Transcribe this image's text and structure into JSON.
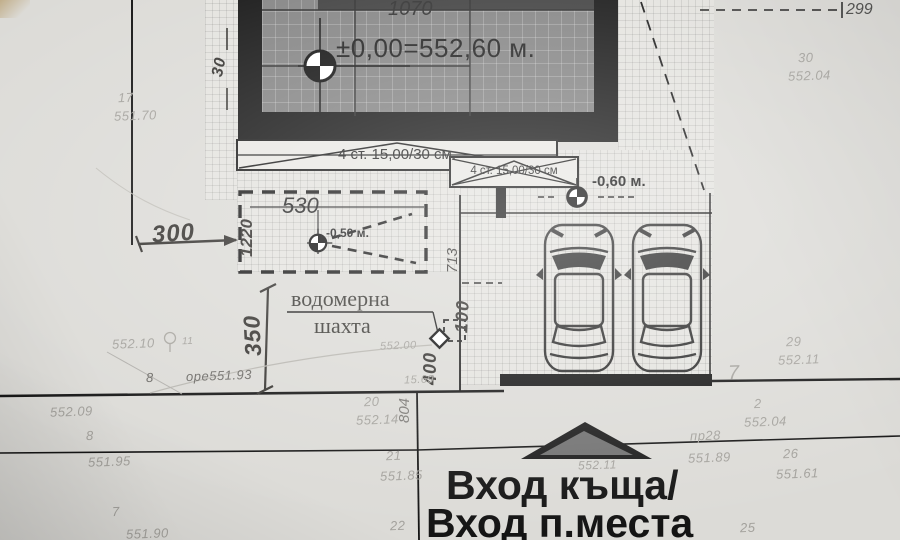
{
  "labels": {
    "dim_1070": "1070",
    "dim_299": "299",
    "elevation_zero": "±0,00=552,60 м.",
    "stairs_1": "4 ст. 15,00/30 см.",
    "stairs_2": "4 ст. 15,00/30 см",
    "dim_530": "530",
    "dim_1220": "1220",
    "terrace_elev": "-0,50 м.",
    "parking_elev": "-0,60 м.",
    "hw_300": "300",
    "hw_350": "350",
    "hw_30": "30",
    "hw_100": "100",
    "hw_400": "400",
    "dim_713": "713",
    "dim_804": "804",
    "water_line1": "водомерна",
    "water_line2": "шахта",
    "entrance_line1": "Вход къща/",
    "entrance_line2": "Вход п.места"
  },
  "survey_points": [
    {
      "label": "17",
      "x": 118,
      "y": 90
    },
    {
      "label": "551.70",
      "x": 114,
      "y": 108
    },
    {
      "label": "30",
      "x": 798,
      "y": 50
    },
    {
      "label": "552.04",
      "x": 788,
      "y": 68
    },
    {
      "label": "29",
      "x": 786,
      "y": 334
    },
    {
      "label": "552.11",
      "x": 778,
      "y": 352
    },
    {
      "label": "552.10",
      "x": 112,
      "y": 336
    },
    {
      "label": "11",
      "x": 182,
      "y": 336,
      "size": 10
    },
    {
      "label": "8",
      "x": 146,
      "y": 370,
      "cls": "dark"
    },
    {
      "label": "оре551.93",
      "x": 186,
      "y": 368,
      "cls": "dark"
    },
    {
      "label": "552.09",
      "x": 50,
      "y": 404
    },
    {
      "label": "8",
      "x": 86,
      "y": 428
    },
    {
      "label": "551.95",
      "x": 88,
      "y": 454
    },
    {
      "label": "7",
      "x": 112,
      "y": 504
    },
    {
      "label": "551.90",
      "x": 126,
      "y": 526
    },
    {
      "label": "20",
      "x": 364,
      "y": 394
    },
    {
      "label": "552.14",
      "x": 356,
      "y": 412
    },
    {
      "label": "21",
      "x": 386,
      "y": 448
    },
    {
      "label": "551.85",
      "x": 380,
      "y": 468
    },
    {
      "label": "22",
      "x": 390,
      "y": 518
    },
    {
      "label": "2",
      "x": 754,
      "y": 396
    },
    {
      "label": "552.04",
      "x": 744,
      "y": 414
    },
    {
      "label": "пр28",
      "x": 690,
      "y": 428
    },
    {
      "label": "551.89",
      "x": 688,
      "y": 450
    },
    {
      "label": "26",
      "x": 783,
      "y": 446
    },
    {
      "label": "551.61",
      "x": 776,
      "y": 466
    },
    {
      "label": "25",
      "x": 740,
      "y": 520
    },
    {
      "label": "7",
      "x": 728,
      "y": 362,
      "size": 20
    },
    {
      "label": "552.00",
      "x": 380,
      "y": 340,
      "size": 11
    },
    {
      "label": "15.69",
      "x": 404,
      "y": 374,
      "size": 11
    },
    {
      "label": "552.11",
      "x": 578,
      "y": 458,
      "size": 12
    }
  ],
  "colors": {
    "paper": "#dcdbd7",
    "building_fill": "#838383",
    "ink": "#181818",
    "faint_text": "#a3a19c"
  }
}
